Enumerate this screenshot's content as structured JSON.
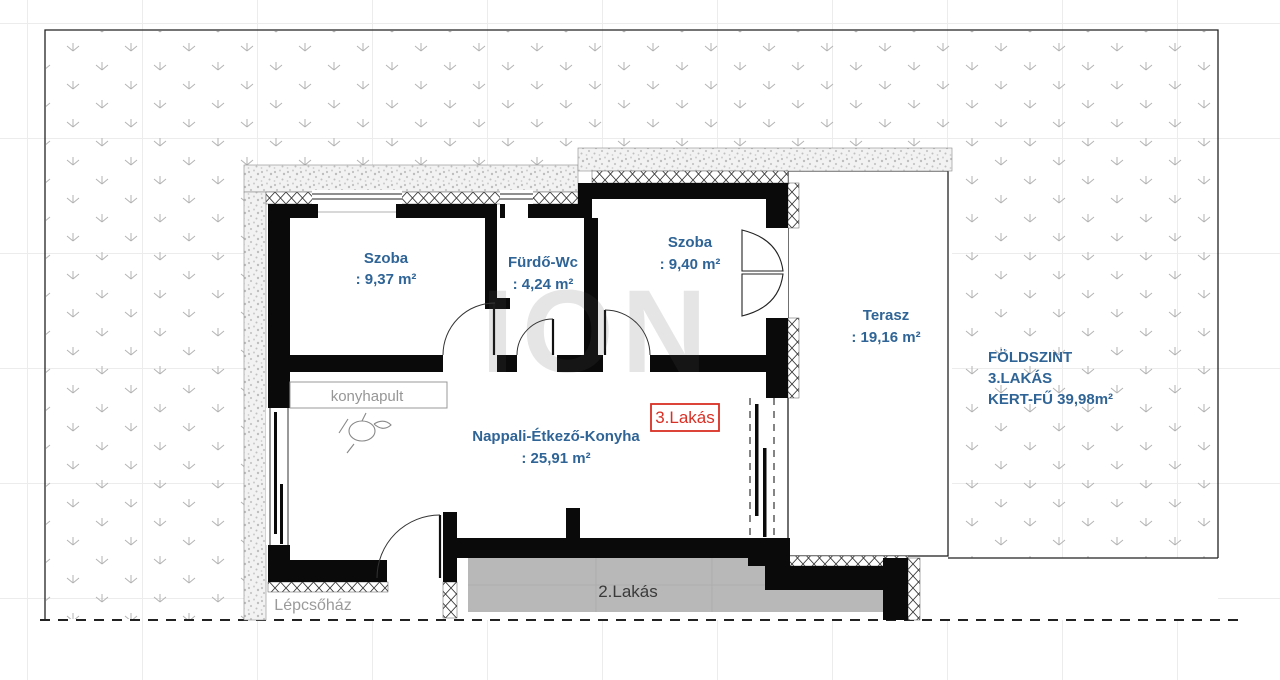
{
  "plan": {
    "rooms": [
      {
        "id": "szoba1",
        "name": "Szoba",
        "area": ": 9,37 m²"
      },
      {
        "id": "furdo",
        "name": "Fürdő-Wc",
        "area": ": 4,24 m²"
      },
      {
        "id": "szoba2",
        "name": "Szoba",
        "area": ": 9,40 m²"
      },
      {
        "id": "terasz",
        "name": "Terasz",
        "area": ": 19,16 m²"
      },
      {
        "id": "nappali",
        "name": "Nappali-Étkező-Konyha",
        "area": ": 25,91 m²"
      }
    ],
    "labels": {
      "unit_badge": "3.Lakás",
      "unit2": "2.Lakás",
      "staircase": "Lépcsőház",
      "counter": "konyhapult",
      "watermark": "ION"
    },
    "site_info": {
      "line1": "FÖLDSZINT",
      "line2": "3.LAKÁS",
      "line3": "KERT-FŰ 39,98m²"
    },
    "colors": {
      "room_label_blue": "#2f6496",
      "unit_badge_red": "#d93025",
      "muted_gray": "#969696",
      "unit2_fill": "#b8b8b8",
      "wall_black": "#0a0a0a"
    }
  }
}
